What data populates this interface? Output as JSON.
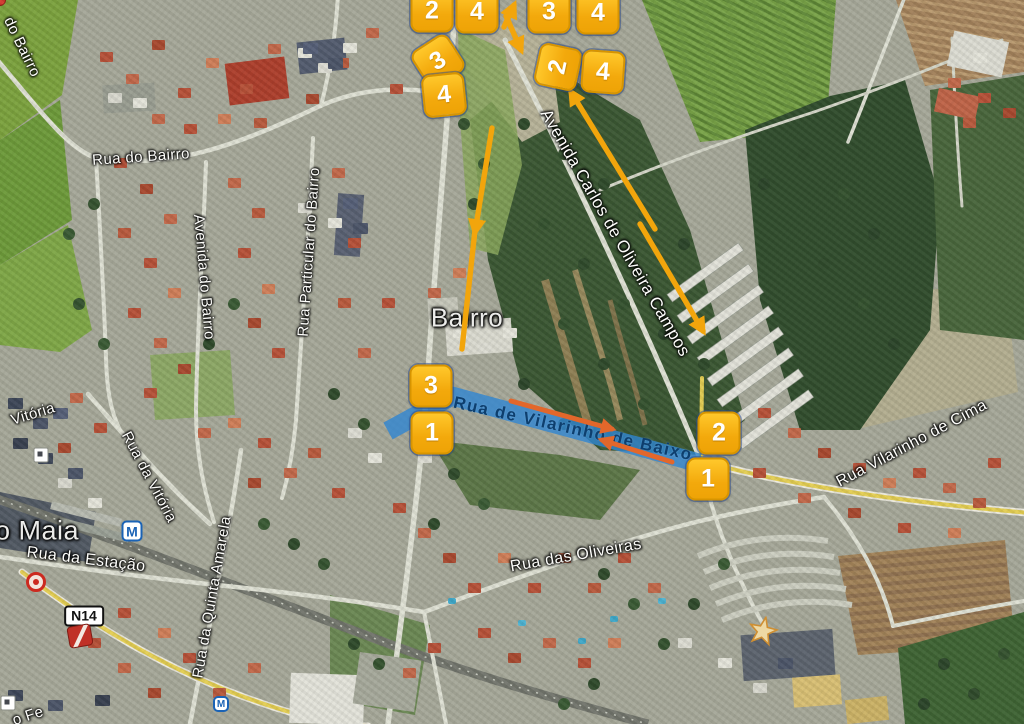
{
  "map": {
    "town_labels": [
      {
        "text": "o Maia",
        "x": 37,
        "y": 531,
        "rot": 0,
        "size": 27
      },
      {
        "text": "Bairro",
        "x": 467,
        "y": 318,
        "rot": 0,
        "size": 26
      }
    ],
    "street_labels": [
      {
        "text": "do Bairro",
        "x": 22,
        "y": 47,
        "rot": 64,
        "size": 15
      },
      {
        "text": "Rua do Bairro",
        "x": 141,
        "y": 157,
        "rot": -4,
        "size": 15
      },
      {
        "text": "Avenida do Bairro",
        "x": 204,
        "y": 277,
        "rot": 85,
        "size": 15
      },
      {
        "text": "Rua Particular do Bairro",
        "x": 309,
        "y": 252,
        "rot": -86,
        "size": 15
      },
      {
        "text": "Vitória",
        "x": 33,
        "y": 414,
        "rot": -17,
        "size": 15
      },
      {
        "text": "Rua da Vitória",
        "x": 149,
        "y": 477,
        "rot": 62,
        "size": 15
      },
      {
        "text": "Rua da Estação",
        "x": 86,
        "y": 560,
        "rot": 7,
        "size": 16
      },
      {
        "text": "Rua da Quinta Amarela",
        "x": 212,
        "y": 597,
        "rot": -80,
        "size": 15
      },
      {
        "text": "Rua das Oliveiras",
        "x": 576,
        "y": 556,
        "rot": -10,
        "size": 16
      },
      {
        "text": "Rua Vilarinho de Cima",
        "x": 912,
        "y": 444,
        "rot": -28,
        "size": 16
      },
      {
        "text": "Avenida Carlos de Oliveira Campos",
        "x": 615,
        "y": 233,
        "rot": 60,
        "size": 17
      },
      {
        "text": "o Fe",
        "x": 28,
        "y": 716,
        "rot": -18,
        "size": 15
      }
    ],
    "route": {
      "name": "Rua de Vilarinho de Baixo",
      "points": "388,431 452,396 699,463",
      "width": 19,
      "opacity": 0.8,
      "label": {
        "x": 573,
        "y": 429,
        "rot": 12.5,
        "size": 17
      }
    },
    "markers": [
      {
        "n": "2",
        "x": 432,
        "y": 11,
        "rot": 0
      },
      {
        "n": "4",
        "x": 477,
        "y": 12,
        "rot": 0
      },
      {
        "n": "3",
        "x": 438,
        "y": 61,
        "rot": -33
      },
      {
        "n": "4",
        "x": 444,
        "y": 95,
        "rot": -6
      },
      {
        "n": "3",
        "x": 549,
        "y": 12,
        "rot": 0
      },
      {
        "n": "4",
        "x": 598,
        "y": 13,
        "rot": 0
      },
      {
        "n": "2",
        "x": 558,
        "y": 67,
        "rot": -78
      },
      {
        "n": "4",
        "x": 603,
        "y": 72,
        "rot": 4
      },
      {
        "n": "3",
        "x": 431,
        "y": 386,
        "rot": 0
      },
      {
        "n": "1",
        "x": 432,
        "y": 433,
        "rot": 0
      },
      {
        "n": "2",
        "x": 719,
        "y": 433,
        "rot": 0
      },
      {
        "n": "1",
        "x": 708,
        "y": 479,
        "rot": 0
      }
    ],
    "arrows": [
      {
        "x1": 504,
        "y1": 27,
        "x2": 514,
        "y2": 5,
        "color": "yellow"
      },
      {
        "x1": 506,
        "y1": 16,
        "x2": 521,
        "y2": 50,
        "color": "yellow"
      },
      {
        "x1": 492,
        "y1": 128,
        "x2": 475,
        "y2": 232,
        "color": "yellow"
      },
      {
        "x1": 475,
        "y1": 230,
        "x2": 462,
        "y2": 349,
        "color": "yellow",
        "head": false
      },
      {
        "x1": 655,
        "y1": 229,
        "x2": 571,
        "y2": 92,
        "color": "yellow"
      },
      {
        "x1": 640,
        "y1": 224,
        "x2": 703,
        "y2": 331,
        "color": "yellow"
      },
      {
        "x1": 511,
        "y1": 401,
        "x2": 612,
        "y2": 429,
        "color": "orange"
      },
      {
        "x1": 672,
        "y1": 462,
        "x2": 602,
        "y2": 440,
        "color": "orange"
      }
    ],
    "icons": {
      "n14": "N14",
      "metro_letter": "M"
    },
    "colors": {
      "marker_fill": "#f3a90c",
      "marker_border": "#d79400",
      "arrow_yellow": "#f2a50c",
      "arrow_orange": "#e2672b",
      "route_blue": "#2f86d2",
      "route_label": "#0e3f6e"
    }
  }
}
